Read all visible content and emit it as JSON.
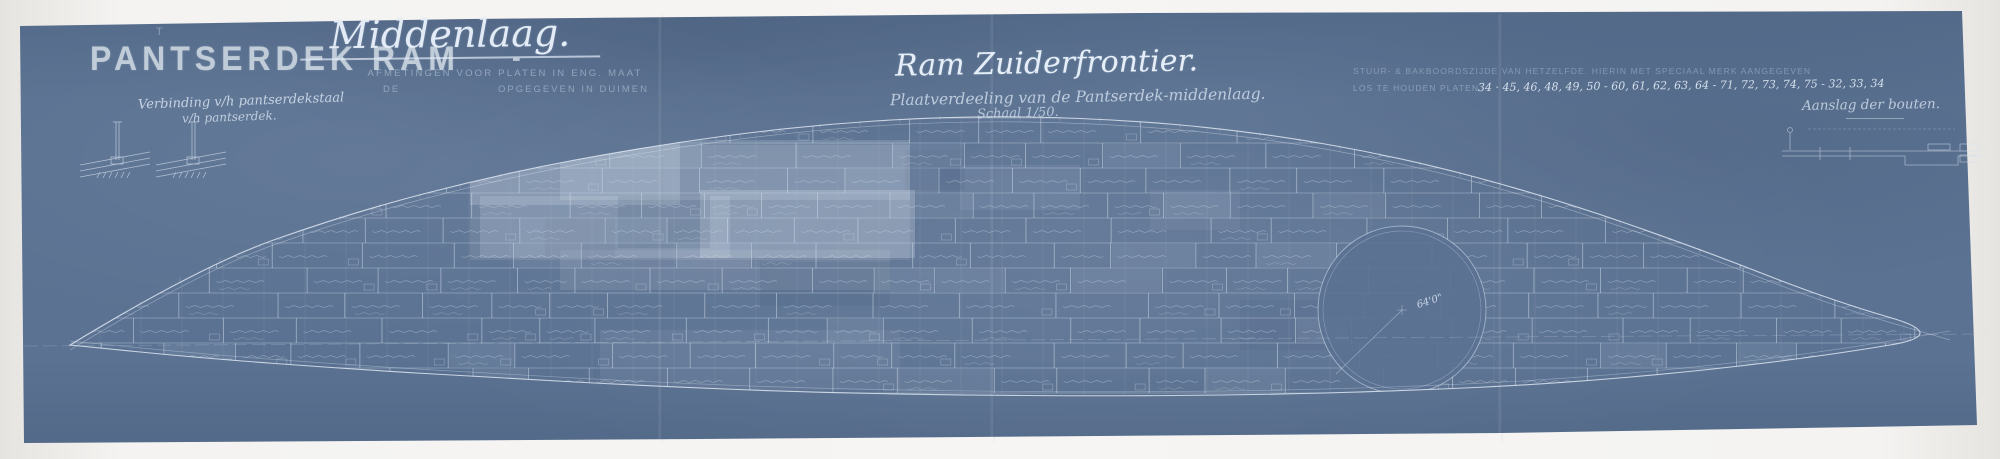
{
  "colors": {
    "paper": "#5b7292",
    "line": "#cfdceb",
    "bright_line": "#e6eef8",
    "stencil": "#c9d4df",
    "margin": "#f0eeeb"
  },
  "header": {
    "stencil_title": "PANTSERDEK RAM",
    "dash": "-",
    "registration_mark": "T",
    "sheet_title": "Middenlaag.",
    "sheet_note_line1": "AFMETINGEN VOOR PLATEN IN ENG. MAAT",
    "sheet_note_line2_left": "DE",
    "sheet_note_line2_right": "OPGEGEVEN IN DUIMEN"
  },
  "title_block": {
    "title": "Ram Zuiderfrontier.",
    "subtitle": "Plaatverdeeling van de Pantserdek-middenlaag.",
    "scale": "Schaal 1/50."
  },
  "annotations": {
    "joint_note_line1": "Verbinding v/h pantserdekstaal",
    "joint_note_line2": "v/h pantserdek.",
    "board_note": "STUUR- & BAKBOORDSZIJDE VAN HETZELFDE. HIERIN MET SPECIAAL MERK AANGEGEVEN",
    "loose_plates_label": "LOS TE HOUDEN PLATEN",
    "loose_plates_numbers": "34 · 45, 46, 48, 49, 50 - 60, 61, 62, 63, 64 - 71, 72, 73, 74, 75 - 32, 33, 34",
    "bolts_note": "Aanslag der bouten."
  },
  "plan": {
    "barbette_label": "64'0\""
  }
}
